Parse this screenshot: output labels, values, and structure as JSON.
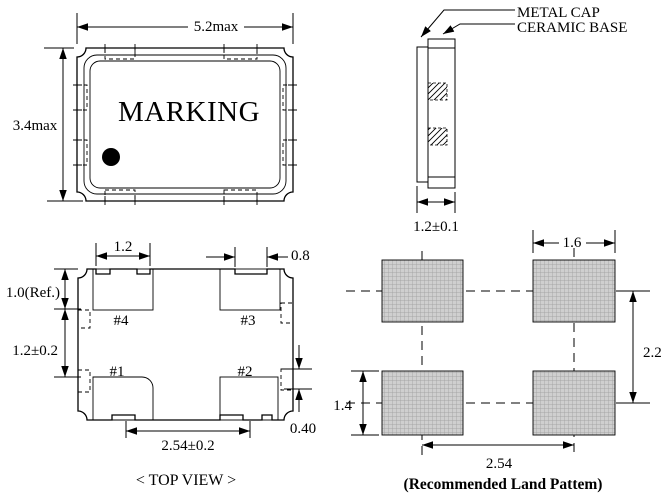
{
  "colors": {
    "ink": "#000000",
    "land_pad_fill": "#cfcfcf",
    "background": "#ffffff"
  },
  "top_view": {
    "marking_text": "MARKING",
    "width_dim": "5.2max",
    "height_dim": "3.4max"
  },
  "side_view": {
    "cap_label": "METAL CAP",
    "base_label": "CERAMIC BASE",
    "thickness_dim": "1.2±0.1"
  },
  "pad_view": {
    "caption": "< TOP VIEW >",
    "pads": [
      "#1",
      "#2",
      "#3",
      "#4"
    ],
    "dim_pad_width": "1.2",
    "dim_notch_width": "0.8",
    "dim_pad_depth": "1.0(Ref.)",
    "dim_pad_gap": "1.2±0.2",
    "dim_pad_pitch": "2.54±0.2",
    "dim_castellation": "0.40"
  },
  "land_pattern": {
    "caption": "(Recommended Land Pattem)",
    "dim_pad_width": "1.6",
    "dim_row_pitch": "2.2",
    "dim_pad_height": "1.4",
    "dim_col_pitch": "2.54"
  }
}
